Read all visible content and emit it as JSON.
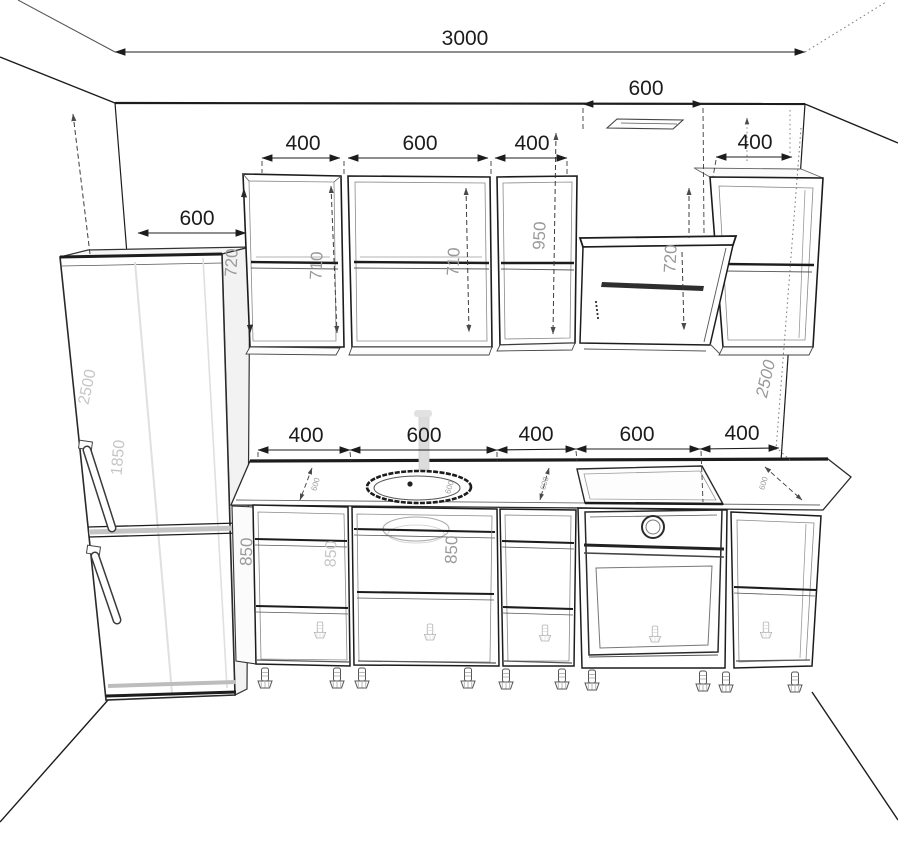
{
  "drawing": {
    "title": "kitchen-elevation-drawing",
    "dimensions": {
      "room_width": "3000",
      "hood_to_corner": "600",
      "corner_to_cabinets": "600",
      "upper_cab_1": "400",
      "upper_cab_2": "600",
      "upper_cab_3": "400",
      "upper_cab_right": "400",
      "base_cab_1": "400",
      "base_cab_2": "600",
      "base_cab_3": "400",
      "base_cab_4": "600",
      "base_cab_5": "400",
      "upper_cab_height": "720",
      "upper_cab_1_inner_height": "710",
      "upper_cab_2_inner_height": "710",
      "tall_upper_height": "950",
      "hood_height": "720",
      "room_height_left": "2500",
      "room_height_right": "2500",
      "fridge_height": "1850",
      "base_height_1": "850",
      "base_height_2": "850",
      "base_height_3": "850",
      "counter_depth_1": "600",
      "counter_depth_2": "600",
      "counter_depth_3": "600",
      "sink_depth": "600"
    },
    "colors": {
      "line": "#1c1c1c",
      "mid_label": "#9a9a9a",
      "faint_label": "#c6c6c6",
      "background": "#ffffff"
    }
  }
}
